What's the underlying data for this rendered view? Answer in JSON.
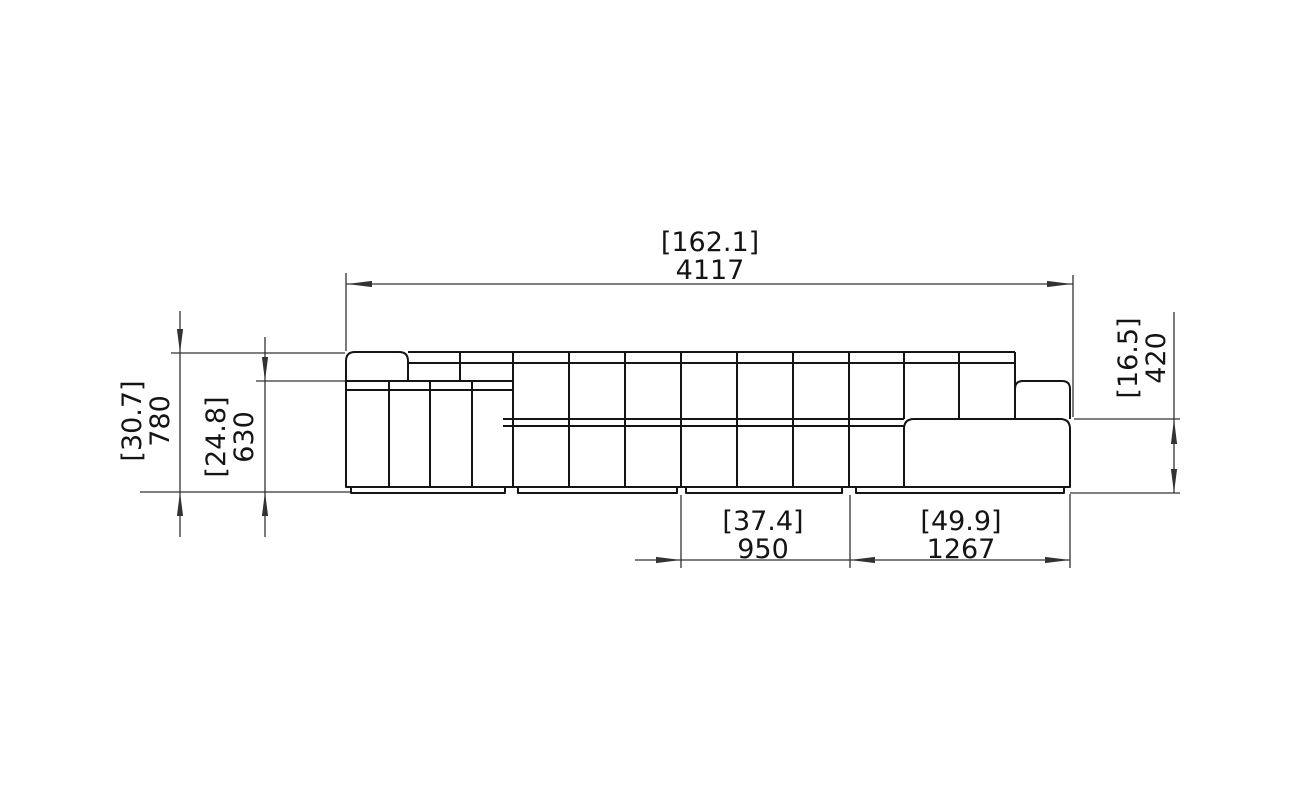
{
  "drawing": {
    "type": "furniture-dimension-drawing",
    "view": "front-elevation",
    "colors": {
      "background": "#ffffff",
      "outline": "#141414",
      "dimension": "#333333"
    }
  },
  "dims": {
    "overall_width": {
      "inches": "[162.1]",
      "mm": "4117"
    },
    "back_height": {
      "inches": "[30.7]",
      "mm": "780"
    },
    "arm_height": {
      "inches": "[24.8]",
      "mm": "630"
    },
    "seat_height": {
      "inches": "[16.5]",
      "mm": "420"
    },
    "module_width": {
      "inches": "[37.4]",
      "mm": "950"
    },
    "chaise_width": {
      "inches": "[49.9]",
      "mm": "1267"
    }
  }
}
